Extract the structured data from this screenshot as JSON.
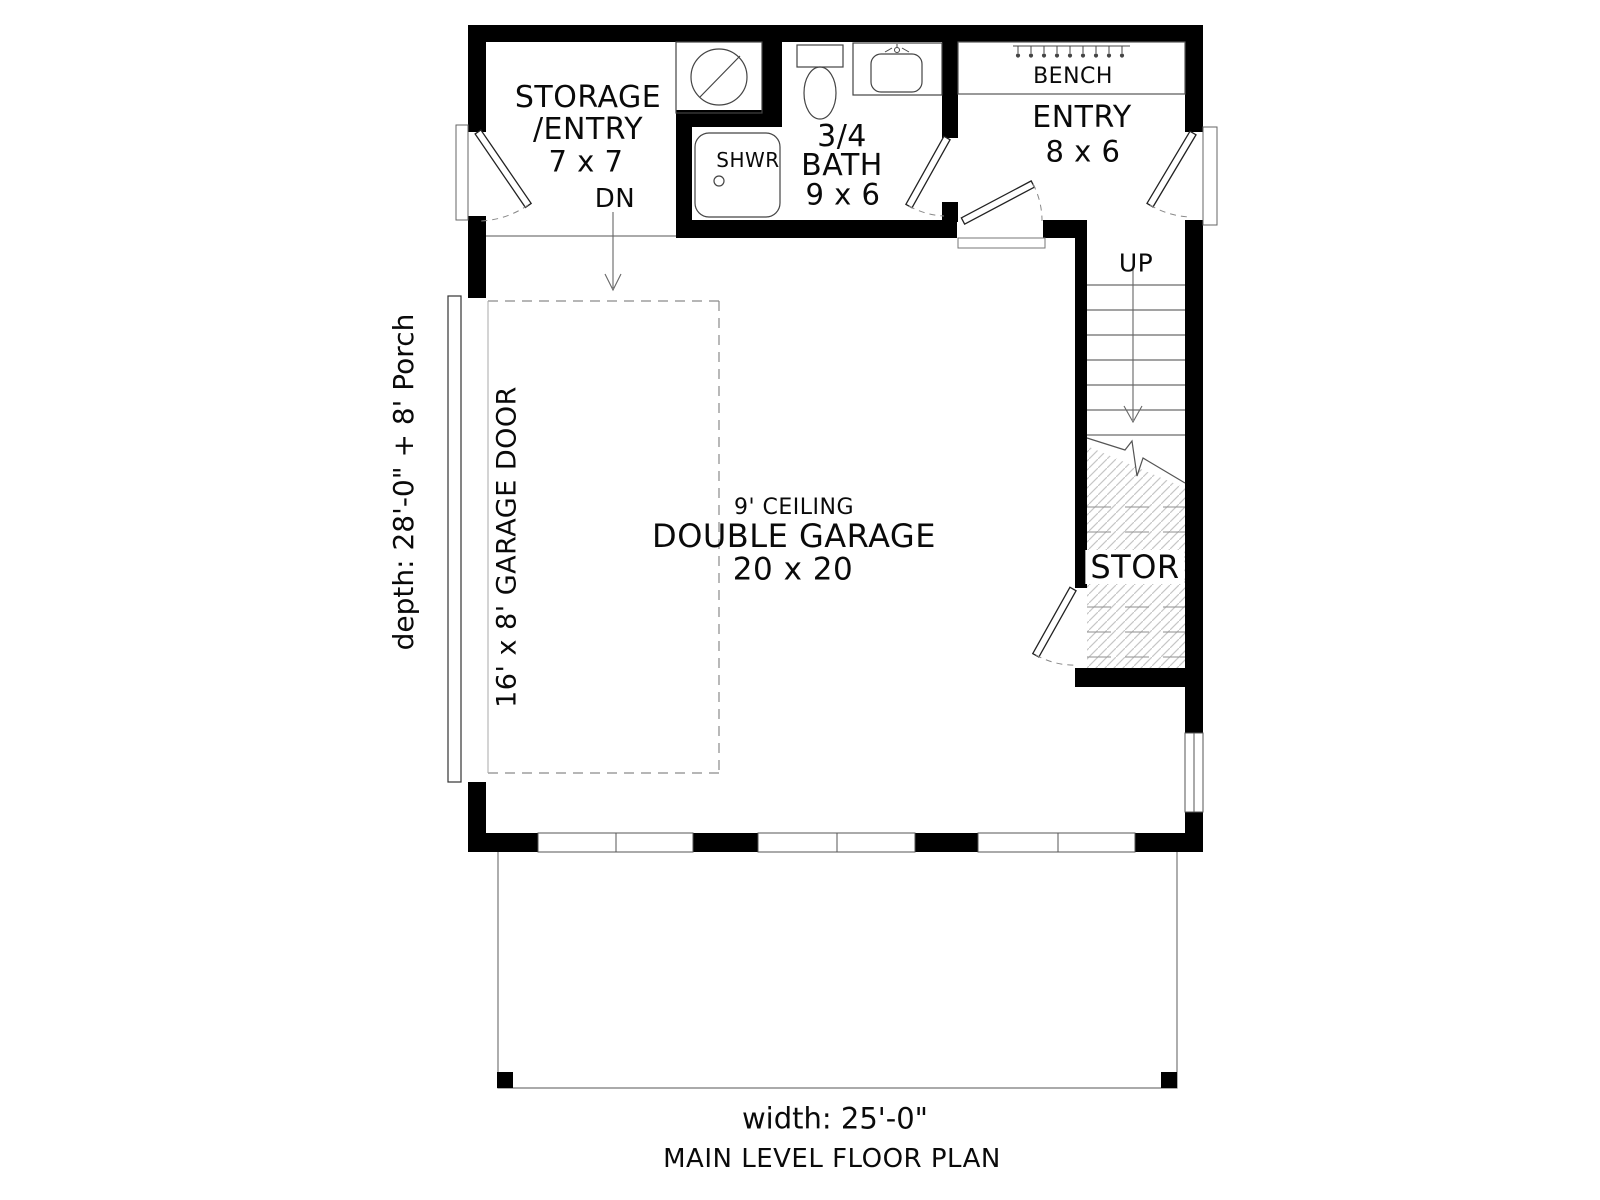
{
  "plan": {
    "title": "MAIN LEVEL FLOOR PLAN",
    "width_label": "width: 25'-0\"",
    "depth_label": "depth: 28'-0\" + 8' Porch",
    "rooms": {
      "storage_entry": {
        "line1": "STORAGE",
        "line2": "/ENTRY",
        "dims": "7 x 7"
      },
      "bath": {
        "line1": "3/4",
        "line2": "BATH",
        "dims": "9 x 6"
      },
      "entry": {
        "name": "ENTRY",
        "dims": "8 x 6"
      },
      "garage": {
        "ceiling": "9' CEILING",
        "name": "DOUBLE GARAGE",
        "dims": "20 x 20"
      },
      "stair_storage": {
        "name": "STOR"
      }
    },
    "annotations": {
      "down": "DN",
      "up": "UP",
      "shower": "SHWR",
      "bench": "BENCH",
      "garage_door": "16' x 8' GARAGE DOOR"
    },
    "colors": {
      "wall": "#000000",
      "thin_line": "#555555",
      "hatch": "#c6c6c6",
      "dash": "#888888"
    }
  }
}
